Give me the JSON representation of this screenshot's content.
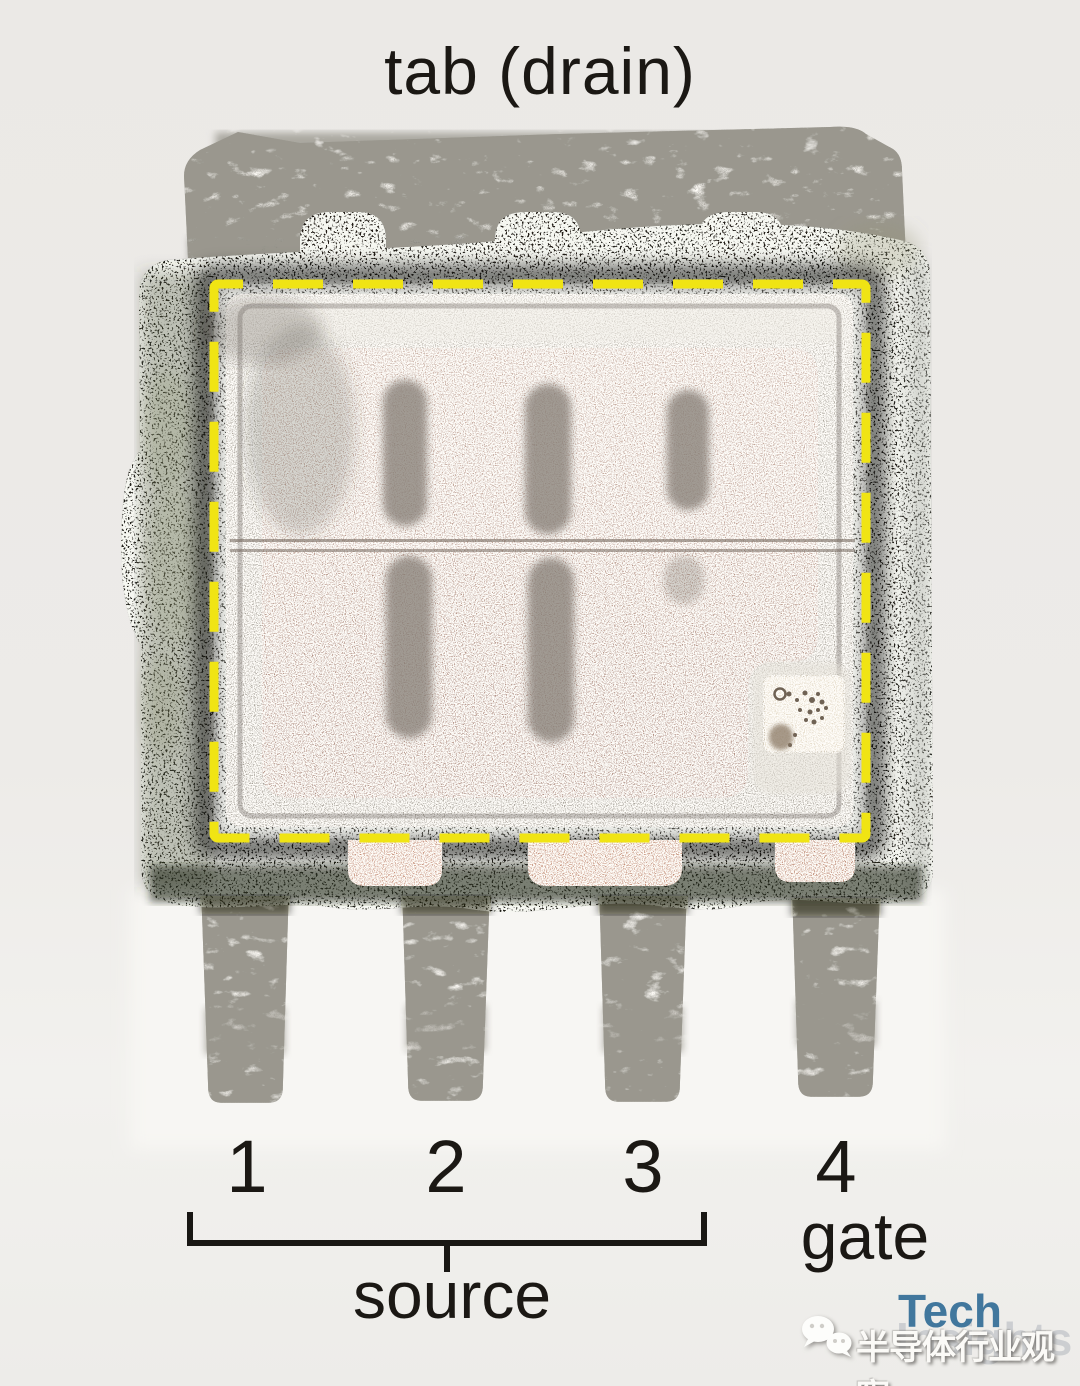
{
  "figure": {
    "background_color": "#edebe8",
    "highlight": {
      "color": "#f0e414",
      "style": "dashed-outline"
    },
    "mold_color": "#24231c",
    "copper_color": "#a87e6d"
  },
  "labels": {
    "tab": "tab (drain)",
    "source": "source",
    "gate": "gate"
  },
  "pins": {
    "numbers": [
      "1",
      "2",
      "3",
      "4"
    ]
  },
  "watermark": {
    "logo_top": "Tech",
    "logo_bottom": "Insights",
    "logo_color": "#41779d",
    "account_name": "半导体行业观察"
  }
}
